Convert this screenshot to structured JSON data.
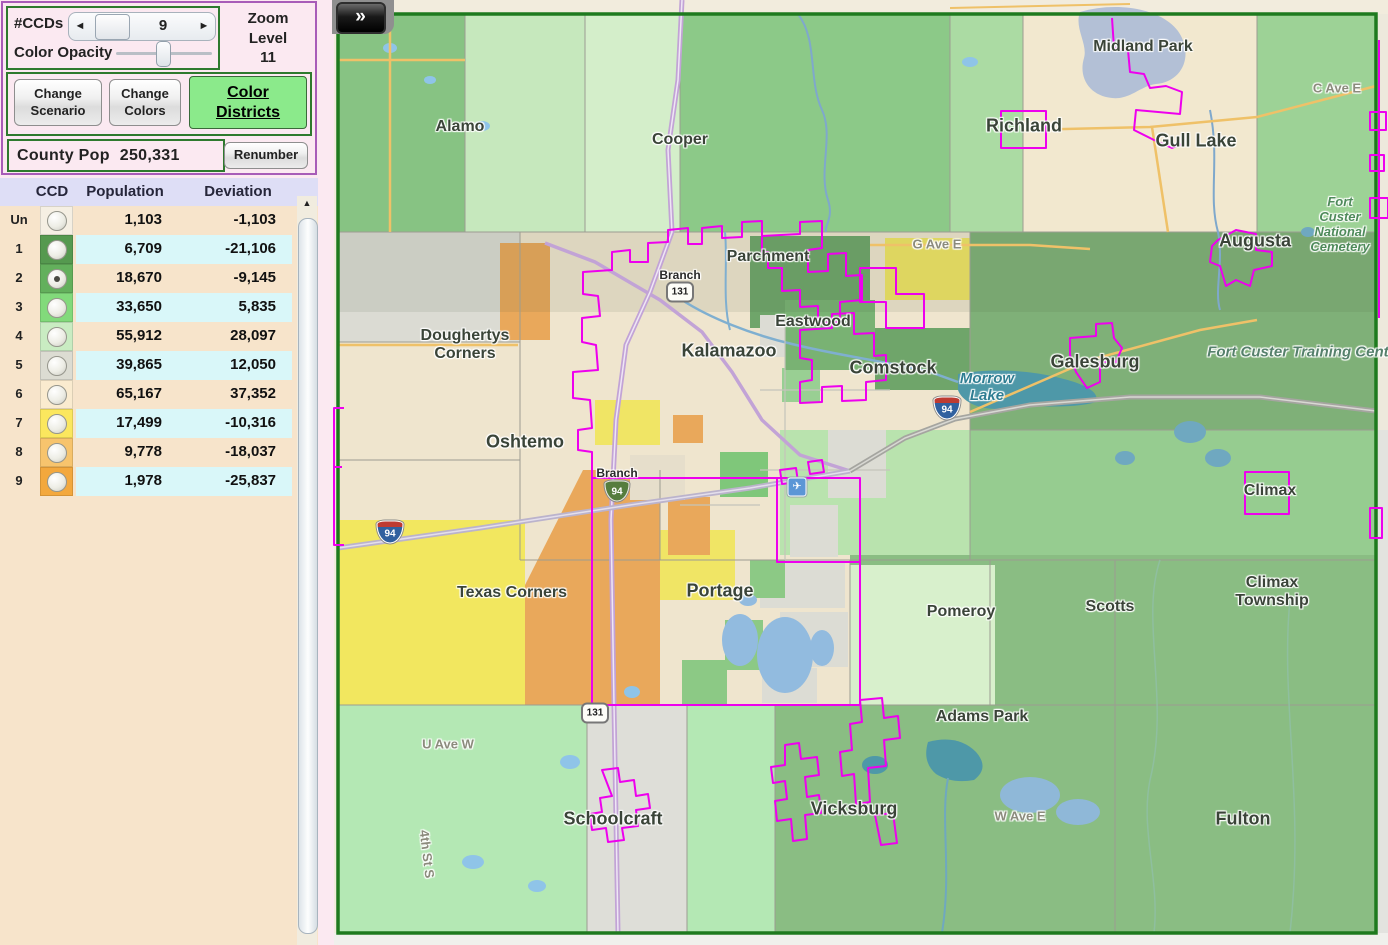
{
  "colors": {
    "magenta": "#EE00EE",
    "county_green": "#1E7A1E",
    "panel_pink": "#FBE9F1",
    "purple_border": "#A85CB8",
    "green_border": "#2E7A2E",
    "accent_green": "#8BEA8B"
  },
  "panel": {
    "ccds_label": "#CCDs",
    "ccds_value": "9",
    "spinner_left": "◄",
    "spinner_right": "►",
    "opacity_label": "Color Opacity",
    "zoom_line1": "Zoom",
    "zoom_line2": "Level",
    "zoom_value": "11",
    "change_scenario": "Change Scenario",
    "change_colors": "Change Colors",
    "color_districts": "Color Districts",
    "county_pop_label": "County Pop",
    "county_pop_value": "250,331",
    "renumber": "Renumber"
  },
  "table": {
    "columns": [
      "CCD",
      "Population",
      "Deviation"
    ],
    "scroll_up_icon": "▲",
    "rows": [
      {
        "id": "Un",
        "color": "#F5EFE3",
        "population": "1,103",
        "deviation": "-1,103",
        "selected": false,
        "stripe": "tan"
      },
      {
        "id": "1",
        "color": "#55994F",
        "population": "6,709",
        "deviation": "-21,106",
        "selected": false,
        "stripe": "cyan"
      },
      {
        "id": "2",
        "color": "#63B05C",
        "population": "18,670",
        "deviation": "-9,145",
        "selected": true,
        "stripe": "tan"
      },
      {
        "id": "3",
        "color": "#82DA7B",
        "population": "33,650",
        "deviation": "5,835",
        "selected": false,
        "stripe": "cyan"
      },
      {
        "id": "4",
        "color": "#C9ECC2",
        "population": "55,912",
        "deviation": "28,097",
        "selected": false,
        "stripe": "tan"
      },
      {
        "id": "5",
        "color": "#DCDCD2",
        "population": "39,865",
        "deviation": "12,050",
        "selected": false,
        "stripe": "cyan"
      },
      {
        "id": "6",
        "color": "#FAEBCF",
        "population": "65,167",
        "deviation": "37,352",
        "selected": false,
        "stripe": "tan"
      },
      {
        "id": "7",
        "color": "#FBE75E",
        "population": "17,499",
        "deviation": "-10,316",
        "selected": false,
        "stripe": "cyan"
      },
      {
        "id": "8",
        "color": "#F7C46D",
        "population": "9,778",
        "deviation": "-18,037",
        "selected": false,
        "stripe": "tan"
      },
      {
        "id": "9",
        "color": "#F3A83D",
        "population": "1,978",
        "deviation": "-25,837",
        "selected": false,
        "stripe": "cyan"
      }
    ]
  },
  "map": {
    "collapse_button": "»",
    "airport_icon": "✈",
    "labels": [
      {
        "text": "Alamo",
        "x": 130,
        "y": 127,
        "cls": "town"
      },
      {
        "text": "Cooper",
        "x": 350,
        "y": 140,
        "cls": "town"
      },
      {
        "text": "Richland",
        "x": 694,
        "y": 126,
        "cls": "city"
      },
      {
        "text": "Midland Park",
        "x": 813,
        "y": 47,
        "cls": "town"
      },
      {
        "text": "Gull Lake",
        "x": 866,
        "y": 141,
        "cls": "city"
      },
      {
        "text": "C Ave E",
        "x": 1007,
        "y": 88,
        "cls": "road"
      },
      {
        "text": "Augusta",
        "x": 925,
        "y": 241,
        "cls": "city"
      },
      {
        "text": "Fort\nCuster\nNational\nCemetery",
        "x": 1010,
        "y": 224,
        "cls": "park"
      },
      {
        "text": "G Ave E",
        "x": 607,
        "y": 244,
        "cls": "road"
      },
      {
        "text": "Parchment",
        "x": 438,
        "y": 257,
        "cls": "town"
      },
      {
        "text": "Eastwood",
        "x": 483,
        "y": 322,
        "cls": "town"
      },
      {
        "text": "Kalamazoo",
        "x": 399,
        "y": 351,
        "cls": "city"
      },
      {
        "text": "Comstock",
        "x": 563,
        "y": 368,
        "cls": "city"
      },
      {
        "text": "Morrow\nLake",
        "x": 657,
        "y": 387,
        "cls": "water"
      },
      {
        "text": "Galesburg",
        "x": 765,
        "y": 362,
        "cls": "city"
      },
      {
        "text": "Fort Custer Training Center",
        "x": 975,
        "y": 352,
        "cls": "park-one"
      },
      {
        "text": "Doughertys\nCorners",
        "x": 135,
        "y": 345,
        "cls": "town"
      },
      {
        "text": "Oshtemo",
        "x": 195,
        "y": 442,
        "cls": "city"
      },
      {
        "text": "Texas Corners",
        "x": 182,
        "y": 593,
        "cls": "town"
      },
      {
        "text": "Portage",
        "x": 390,
        "y": 591,
        "cls": "city"
      },
      {
        "text": "Pomeroy",
        "x": 631,
        "y": 612,
        "cls": "town"
      },
      {
        "text": "Scotts",
        "x": 780,
        "y": 607,
        "cls": "town"
      },
      {
        "text": "Climax",
        "x": 940,
        "y": 491,
        "cls": "town"
      },
      {
        "text": "Climax\nTownship",
        "x": 942,
        "y": 592,
        "cls": "town"
      },
      {
        "text": "Adams Park",
        "x": 652,
        "y": 717,
        "cls": "town"
      },
      {
        "text": "U Ave W",
        "x": 118,
        "y": 744,
        "cls": "road"
      },
      {
        "text": "W Ave E",
        "x": 690,
        "y": 816,
        "cls": "road"
      },
      {
        "text": "Vicksburg",
        "x": 524,
        "y": 809,
        "cls": "city"
      },
      {
        "text": "Schoolcraft",
        "x": 283,
        "y": 819,
        "cls": "city"
      },
      {
        "text": "Fulton",
        "x": 913,
        "y": 819,
        "cls": "city"
      },
      {
        "text": "4th St S",
        "x": 97,
        "y": 854,
        "cls": "road-vert"
      },
      {
        "text": "Branch",
        "x": 350,
        "y": 275,
        "cls": "branch"
      },
      {
        "text": "Branch",
        "x": 287,
        "y": 473,
        "cls": "branch"
      }
    ],
    "shields": [
      {
        "kind": "us",
        "text": "131",
        "x": 350,
        "y": 292
      },
      {
        "kind": "bus",
        "text": "94",
        "x": 287,
        "y": 491
      },
      {
        "kind": "int",
        "text": "94",
        "x": 617,
        "y": 408
      },
      {
        "kind": "int",
        "text": "94",
        "x": 60,
        "y": 532
      },
      {
        "kind": "us",
        "text": "131",
        "x": 265,
        "y": 713
      }
    ],
    "airport": {
      "x": 467,
      "y": 487
    }
  }
}
